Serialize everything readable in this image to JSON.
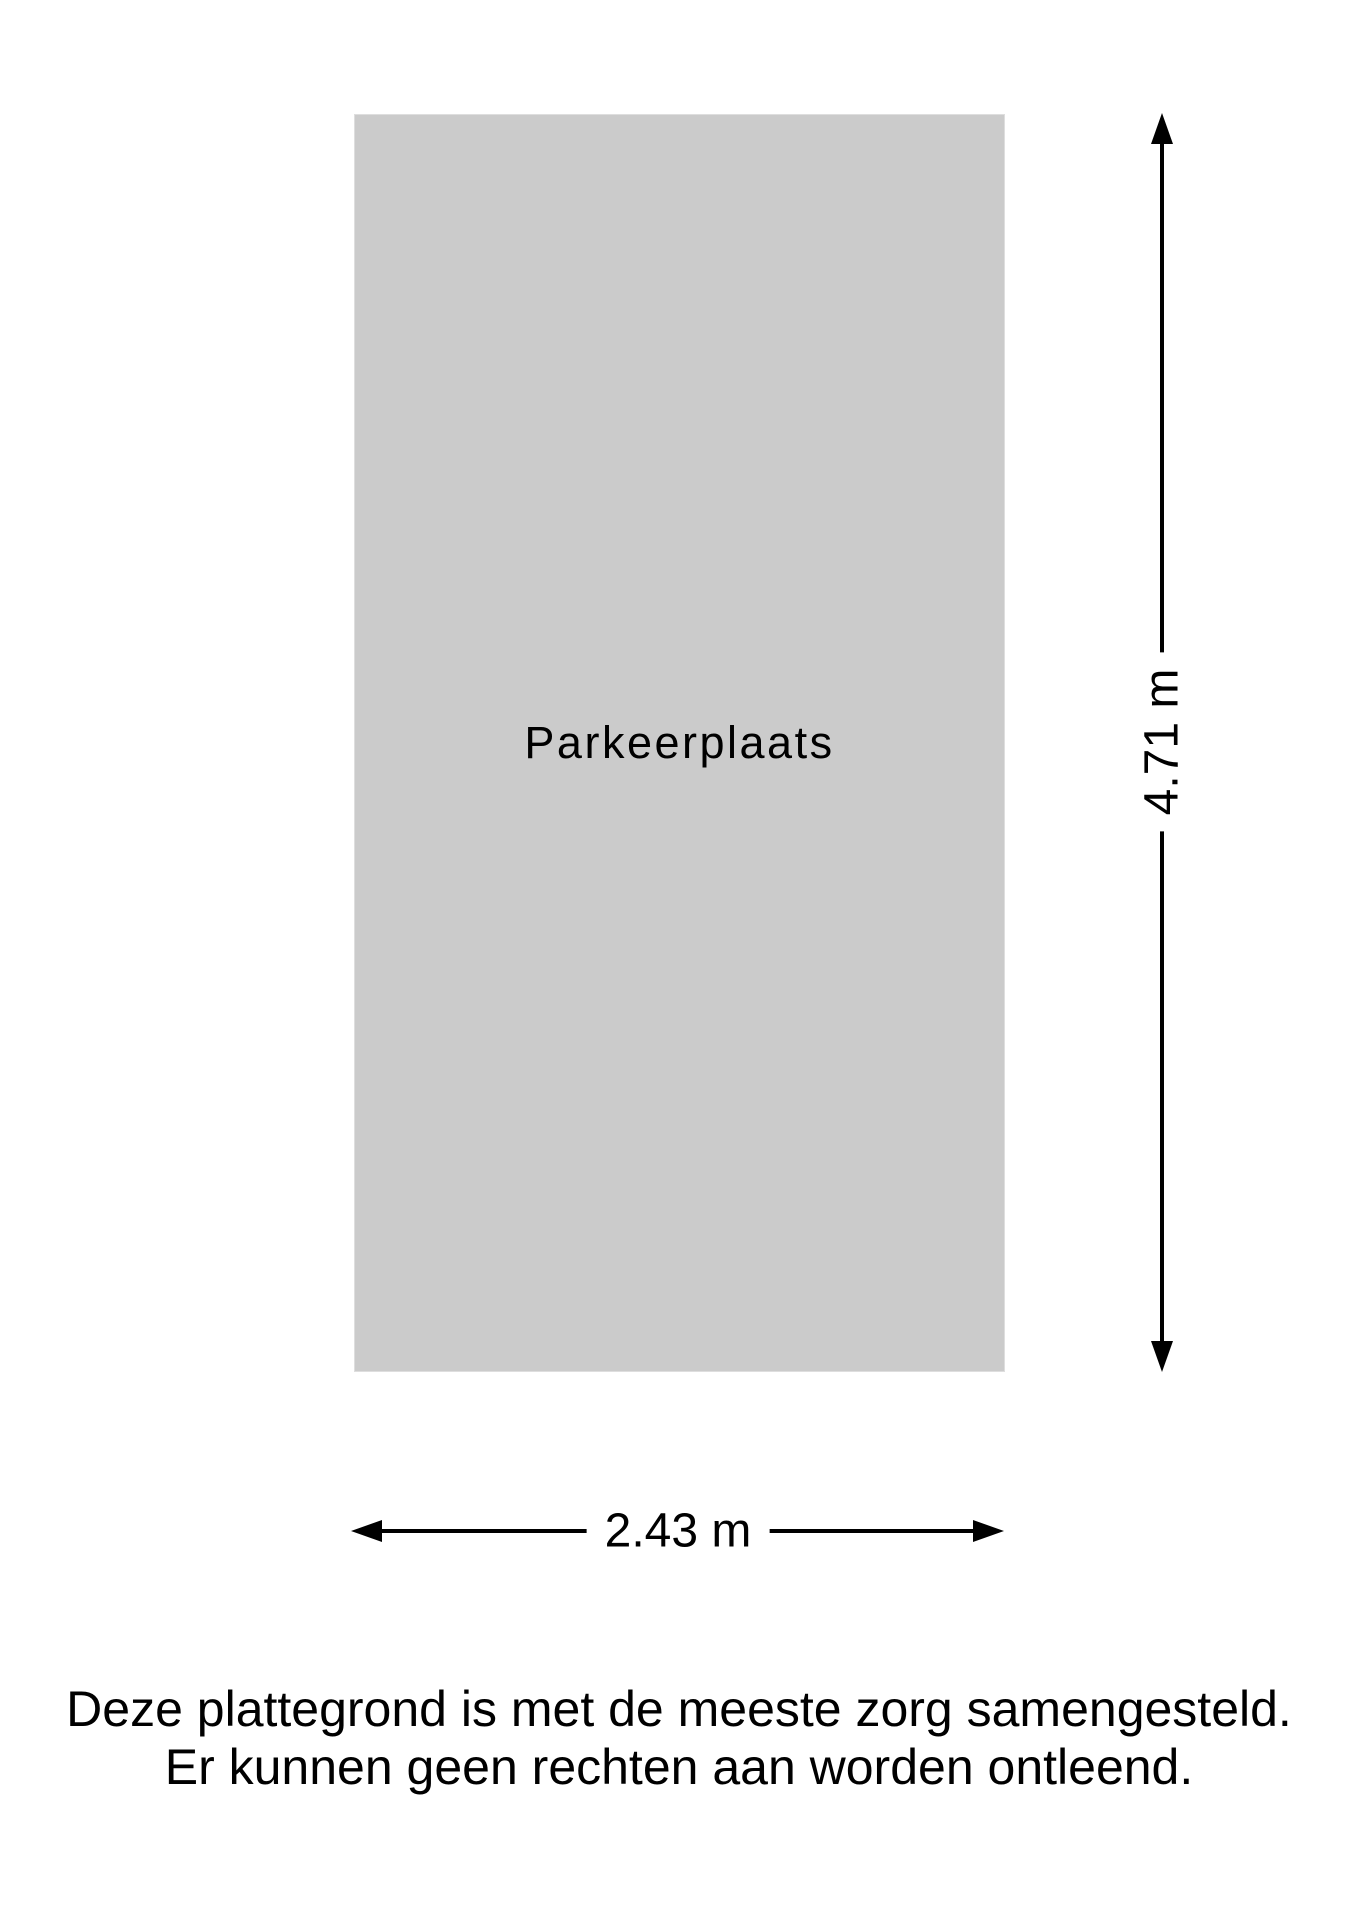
{
  "floorplan": {
    "room_label": "Parkeerplaats",
    "fill_color": "#cbcbcb",
    "line_color": "#000000"
  },
  "dimensions": {
    "height_label": "4.71 m",
    "width_label": "2.43 m"
  },
  "disclaimer": {
    "line1": "Deze plattegrond is met de meeste zorg samengesteld.",
    "line2": "Er kunnen geen rechten aan worden ontleend."
  }
}
